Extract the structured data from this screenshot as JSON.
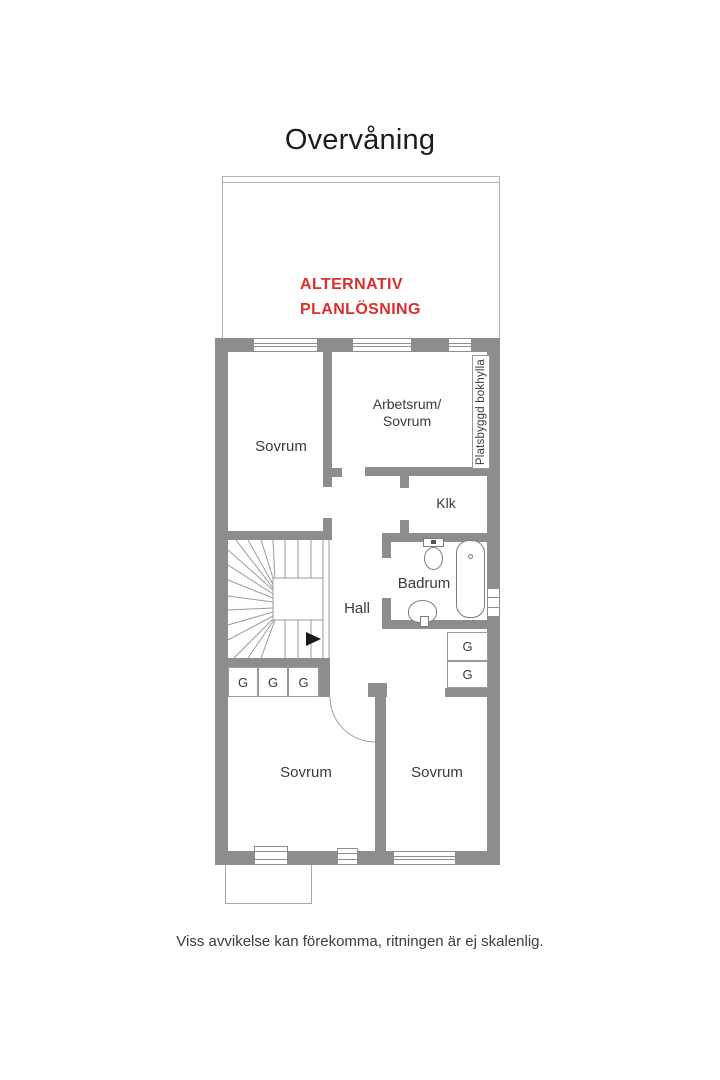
{
  "title": "Overvåning",
  "alt_plan": {
    "line1": "ALTERNATIV",
    "line2": "PLANLÖSNING"
  },
  "labels": {
    "bedroom_top": "Sovrum",
    "office_line1": "Arbetsrum/",
    "office_line2": "Sovrum",
    "bookshelf": "Platsbyggd bokhylla",
    "closet_klk": "Klk",
    "bathroom": "Badrum",
    "hall": "Hall",
    "wardrobe": "G",
    "bedroom_bottom_left": "Sovrum",
    "bedroom_bottom_right": "Sovrum"
  },
  "footer": {
    "note": "Viss avvikelse kan förekomma, ritningen är ej skalenlig."
  },
  "colors": {
    "wall": "#8d8d8d",
    "accent_red": "#d92e2e",
    "label_text": "#3a3a3a"
  }
}
